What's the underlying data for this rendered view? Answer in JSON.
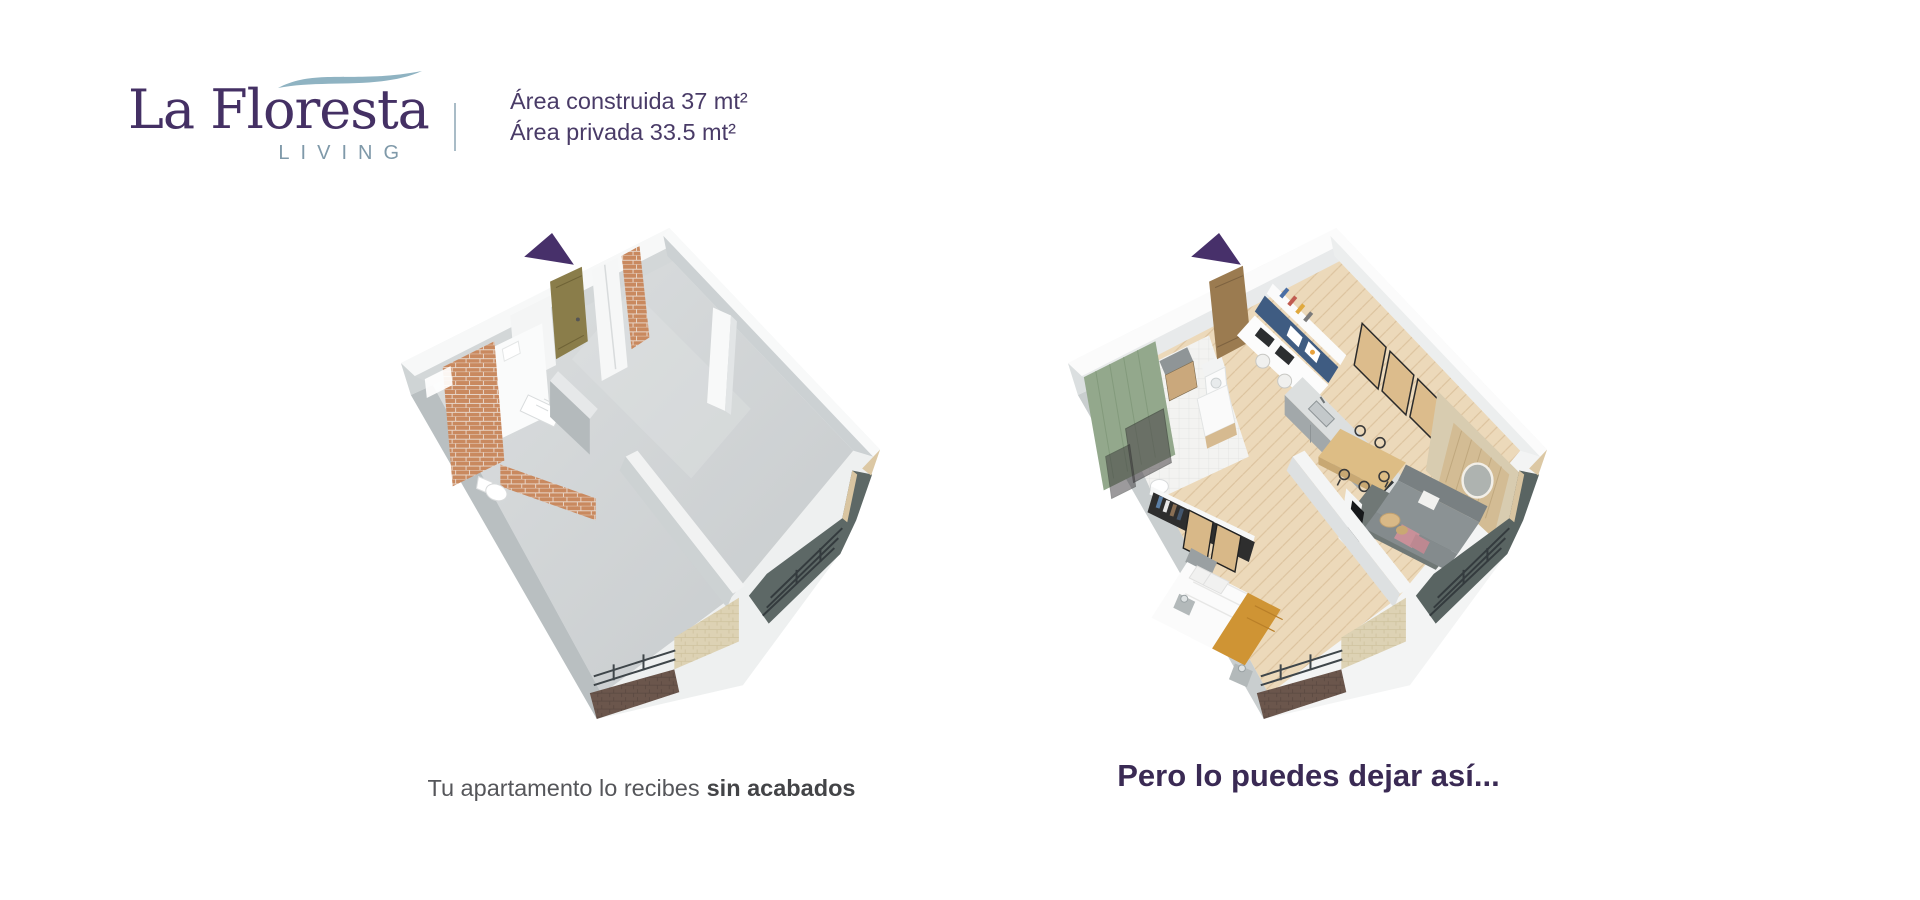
{
  "brand": {
    "title": "La Floresta",
    "subtitle": "LIVING"
  },
  "header": {
    "area_built": "Área construida 37 mt²",
    "area_private": "Área privada 33.5 mt²"
  },
  "left_plan": {
    "caption_prefix": "Tu apartamento lo recibes",
    "caption_bold": "sin acabados"
  },
  "right_plan": {
    "caption": "Pero lo puedes dejar así..."
  },
  "colors": {
    "brand_purple": "#443064",
    "living_gray_blue": "#7f99a9",
    "wave_blue": "#8fb3c2",
    "area_text_purple": "#493b67",
    "caption_gray": "#55565a",
    "caption_purple": "#3a2a54",
    "marker_purple": "#47306a",
    "brick_terracotta": "#c9895f",
    "concrete_gray": "#d4d7d8",
    "wood_floor": "#ecd9ba",
    "bathroom_green": "#93a88c",
    "desk_navy": "#3f5c82",
    "balcony_dark": "#5d6866",
    "throw_mustard": "#cf9434"
  }
}
